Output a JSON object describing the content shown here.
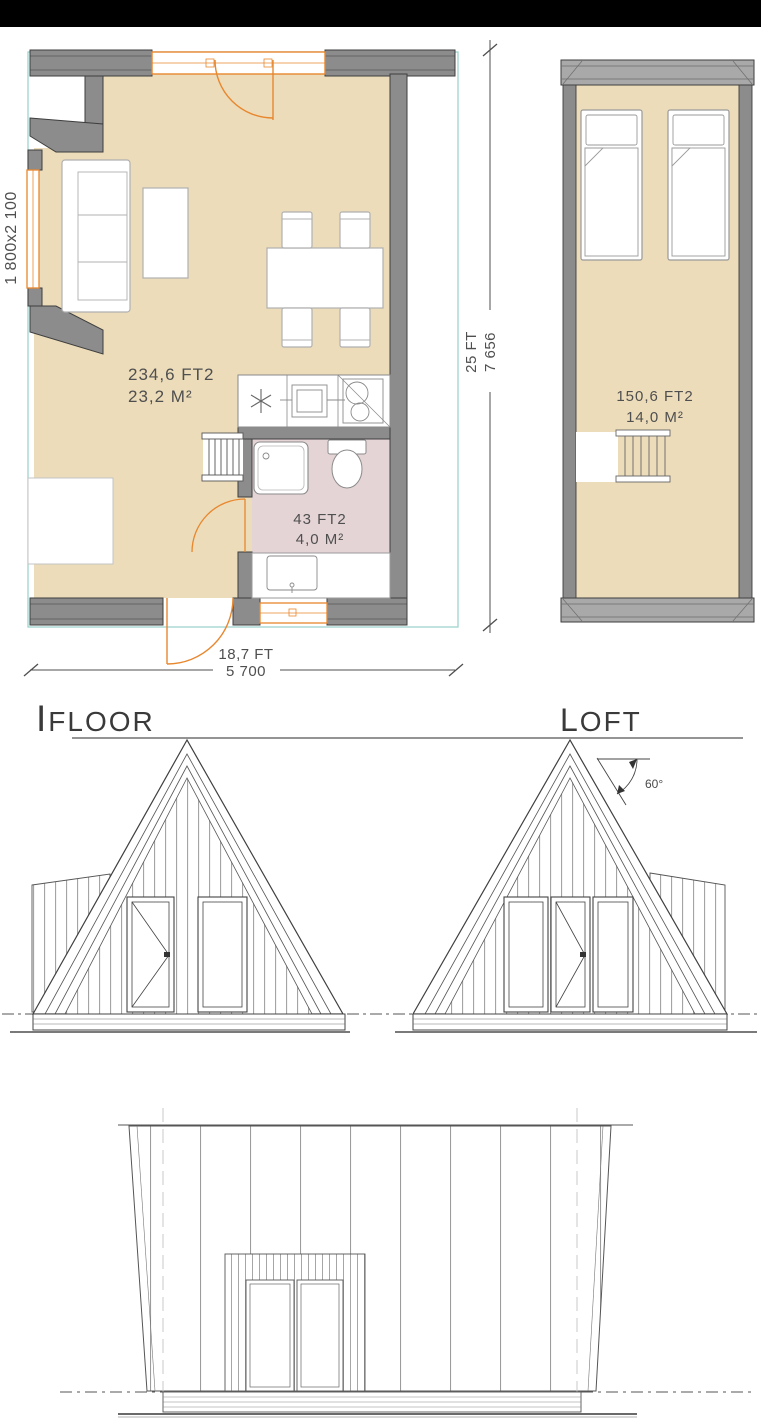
{
  "colors": {
    "background": "#ffffff",
    "top_bar": "#000000",
    "floor_fill": "#ecdcba",
    "bathroom_fill": "#e4d4d6",
    "wall_fill": "#8c8c8c",
    "wall_band_fill": "#a9a9a9",
    "wall_stroke": "#3e3e3e",
    "joinery_orange": "#e8872e",
    "footprint_teal": "#9fd4ce",
    "drawing_line": "#4f4f4f"
  },
  "first_floor": {
    "label_initial": "I",
    "label_rest": "FLOOR",
    "living_area_ft": "234,6 FT2",
    "living_area_m": "23,2 M²",
    "bathroom_area_ft": "43 FT2",
    "bathroom_area_m": "4,0 M²",
    "window_dimension": "1 800x2 100",
    "width_ft": "18,7 FT",
    "width_mm": "5 700",
    "depth_ft": "25 FT",
    "depth_mm": "7 656"
  },
  "loft": {
    "label_initial": "L",
    "label_rest": "OFT",
    "area_ft": "150,6 FT2",
    "area_m": "14,0 M²"
  },
  "elevations": {
    "roof_angle_label": "60°"
  }
}
